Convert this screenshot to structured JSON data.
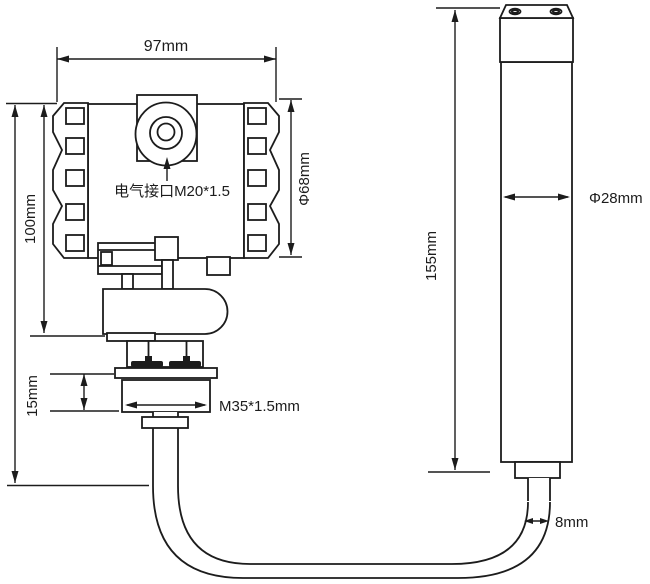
{
  "page": {
    "background": "#ffffff",
    "line_color": "#1c1c1c",
    "text_color": "#1c1c1c",
    "description": "Dimensional drawing of transmitter housing and sensor probe"
  },
  "transmitter_view": {
    "dims": {
      "width": "97mm",
      "height": "100mm",
      "housing_diameter": "Φ68mm",
      "thread_section_height": "15mm"
    },
    "labels": {
      "electrical_interface": "电气接口M20*1.5",
      "process_thread": "M35*1.5mm"
    }
  },
  "probe_view": {
    "dims": {
      "length": "155mm",
      "diameter": "Φ28mm",
      "cable_diameter": "8mm"
    }
  }
}
